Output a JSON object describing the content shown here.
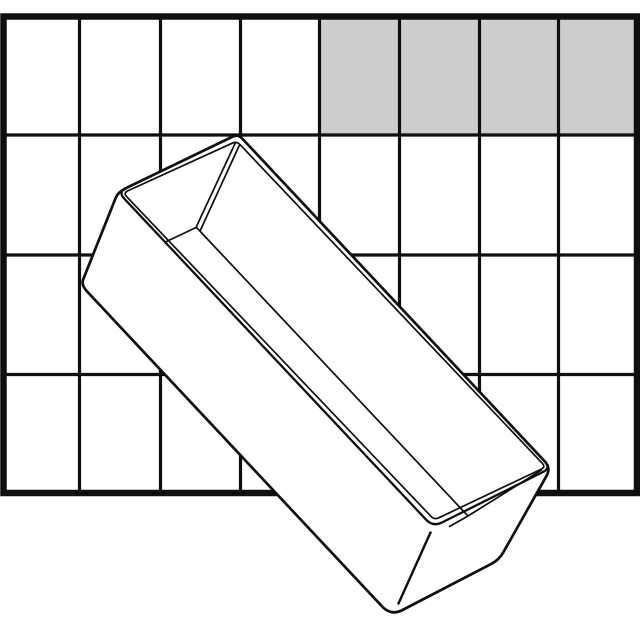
{
  "canvas": {
    "width": 640,
    "height": 640,
    "background": "#ffffff"
  },
  "drawing": {
    "line_color": "#0f0f0f",
    "grid": {
      "columns": 8,
      "rows": 4,
      "frame": {
        "x": 3.5,
        "y": 16.5,
        "width": 633.5,
        "height": 476.5
      },
      "outer_stroke": 6.5,
      "inner_stroke": 3.2,
      "vertical_lines_x": [
        79.5,
        160.5,
        240.5,
        319.5,
        399.5,
        479.5,
        558.5
      ],
      "horizontal_lines_y": [
        135,
        255,
        374.5
      ],
      "cell_fill": "#ffffff"
    },
    "highlight_area": {
      "fill": "#cccdcf",
      "x": 319.5,
      "y": 16.5,
      "width": 317.5,
      "height": 118.5,
      "col_start": 5,
      "row_start": 1,
      "col_span": 4,
      "row_span": 1
    },
    "insert_box": {
      "fill": "#ffffff",
      "outline_stroke": 2.7,
      "rim_stroke": 2.3,
      "detail_stroke": 1.7,
      "edge_stroke": 2.4
    }
  }
}
